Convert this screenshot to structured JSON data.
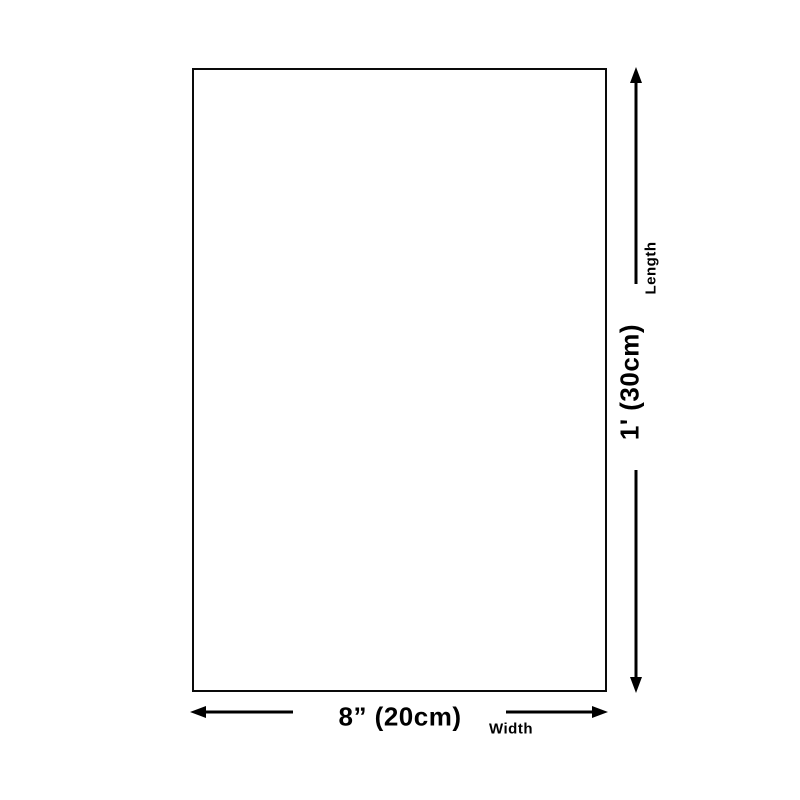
{
  "diagram": {
    "type": "product-dimension-diagram",
    "colors": {
      "background": "#ffffff",
      "line": "#000000",
      "rectangle_border": "#0a0a0a"
    },
    "rectangle": {
      "shape": "vertical rectangle outline, empty interior"
    },
    "dimensions": {
      "length": {
        "value": "1' (30cm)",
        "label": "Length",
        "orientation": "vertical",
        "side": "right"
      },
      "width": {
        "value": "8” (20cm)",
        "label": "Width",
        "orientation": "horizontal",
        "side": "bottom"
      }
    }
  }
}
